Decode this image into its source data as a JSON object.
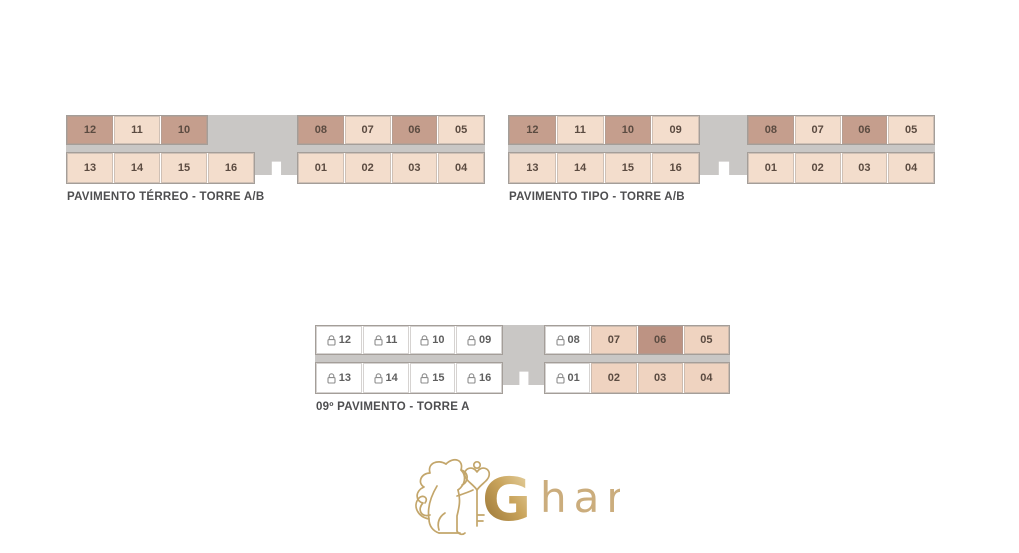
{
  "colors": {
    "unit_dark": "#c59e8d",
    "unit_light": "#f3ddcc",
    "unit_peach": "#efd3c0",
    "unit_dark_alt": "#bd9383",
    "unit_locked": "#ffffff",
    "corridor_gray": "#c9c7c5",
    "title_text": "#4e4e50",
    "unit_text": "#5b4b41",
    "logo_gold": "#c3a66b"
  },
  "plans": [
    {
      "title": "PAVIMENTO TÉRREO - TORRE A/B",
      "blocks": {
        "top_left": [
          {
            "num": "12",
            "variant": "dark"
          },
          {
            "num": "11",
            "variant": "light"
          },
          {
            "num": "10",
            "variant": "dark"
          }
        ],
        "top_right": [
          {
            "num": "08",
            "variant": "dark"
          },
          {
            "num": "07",
            "variant": "light"
          },
          {
            "num": "06",
            "variant": "dark"
          },
          {
            "num": "05",
            "variant": "light"
          }
        ],
        "bottom_left": [
          {
            "num": "13",
            "variant": "light"
          },
          {
            "num": "14",
            "variant": "light"
          },
          {
            "num": "15",
            "variant": "light"
          },
          {
            "num": "16",
            "variant": "light"
          }
        ],
        "bottom_right": [
          {
            "num": "01",
            "variant": "light"
          },
          {
            "num": "02",
            "variant": "light"
          },
          {
            "num": "03",
            "variant": "light"
          },
          {
            "num": "04",
            "variant": "light"
          }
        ]
      }
    },
    {
      "title": "PAVIMENTO TIPO - TORRE A/B",
      "blocks": {
        "top_left": [
          {
            "num": "12",
            "variant": "dark"
          },
          {
            "num": "11",
            "variant": "light"
          },
          {
            "num": "10",
            "variant": "dark"
          },
          {
            "num": "09",
            "variant": "light"
          }
        ],
        "top_right": [
          {
            "num": "08",
            "variant": "dark"
          },
          {
            "num": "07",
            "variant": "light"
          },
          {
            "num": "06",
            "variant": "dark"
          },
          {
            "num": "05",
            "variant": "light"
          }
        ],
        "bottom_left": [
          {
            "num": "13",
            "variant": "light"
          },
          {
            "num": "14",
            "variant": "light"
          },
          {
            "num": "15",
            "variant": "light"
          },
          {
            "num": "16",
            "variant": "light"
          }
        ],
        "bottom_right": [
          {
            "num": "01",
            "variant": "light"
          },
          {
            "num": "02",
            "variant": "light"
          },
          {
            "num": "03",
            "variant": "light"
          },
          {
            "num": "04",
            "variant": "light"
          }
        ]
      }
    },
    {
      "title": "09º PAVIMENTO - TORRE A",
      "blocks": {
        "top_left": [
          {
            "num": "12",
            "variant": "locked"
          },
          {
            "num": "11",
            "variant": "locked"
          },
          {
            "num": "10",
            "variant": "locked"
          },
          {
            "num": "09",
            "variant": "locked"
          }
        ],
        "top_right": [
          {
            "num": "08",
            "variant": "locked"
          },
          {
            "num": "07",
            "variant": "peach"
          },
          {
            "num": "06",
            "variant": "dark2"
          },
          {
            "num": "05",
            "variant": "peach"
          }
        ],
        "bottom_left": [
          {
            "num": "13",
            "variant": "locked"
          },
          {
            "num": "14",
            "variant": "locked"
          },
          {
            "num": "15",
            "variant": "locked"
          },
          {
            "num": "16",
            "variant": "locked"
          }
        ],
        "bottom_right": [
          {
            "num": "01",
            "variant": "locked"
          },
          {
            "num": "02",
            "variant": "peach"
          },
          {
            "num": "03",
            "variant": "peach"
          },
          {
            "num": "04",
            "variant": "peach"
          }
        ]
      }
    }
  ],
  "logo": {
    "brand_initial": "G",
    "brand_rest": "har",
    "icon": "lion-with-key"
  }
}
